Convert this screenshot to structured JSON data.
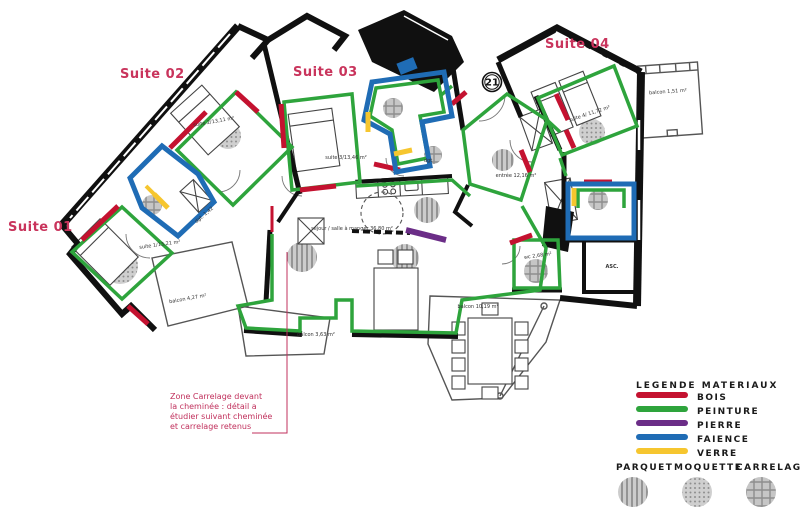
{
  "plan": {
    "suite_titles": [
      {
        "label": "Suite 01"
      },
      {
        "label": "Suite 02"
      },
      {
        "label": "Suite 03"
      },
      {
        "label": "Suite 04"
      }
    ],
    "unit_badge": "21",
    "labels": {
      "suite1": "suite 1/13,21 m²",
      "suite2": "suite 2/13,11 m²",
      "suite3": "suite 3/13,46 m²",
      "suite4": "suite 4/ 11,72 m²",
      "entree": "entrée 12,16 m²",
      "sejour": "séjour / salle à manger 36,80 m²",
      "wc": "wc 2,68 m²",
      "asc": "ASC.",
      "dgt": "dgt. 1,42",
      "dgt2": "dgt",
      "balcon_suite1": "balcon 4,27 m²",
      "balcon_sejour": "balcon 3,63 m²",
      "balcon_grand": "balcon 10,19 m²",
      "balcon_suite4": "balcon 1,51 m²"
    },
    "annotation": {
      "line1": "Zone Carrelage devant",
      "line2": "la cheminée : détail a",
      "line3": "étudier suivant cheminée",
      "line4": "et carrelage retenus"
    }
  },
  "legend": {
    "title": "LEGENDE MATERIAUX",
    "materials": [
      {
        "label": "BOIS",
        "color": "#C41230"
      },
      {
        "label": "PEINTURE",
        "color": "#2EA43C"
      },
      {
        "label": "PIERRE",
        "color": "#6B2D87"
      },
      {
        "label": "FAIENCE",
        "color": "#1F6CB5"
      },
      {
        "label": "VERRE",
        "color": "#F6C62F"
      }
    ],
    "floors": [
      {
        "label": "PARQUET",
        "pattern": "stripes"
      },
      {
        "label": "MOQUETTE",
        "pattern": "dots"
      },
      {
        "label": "CARRELAGE",
        "pattern": "grid"
      }
    ]
  }
}
